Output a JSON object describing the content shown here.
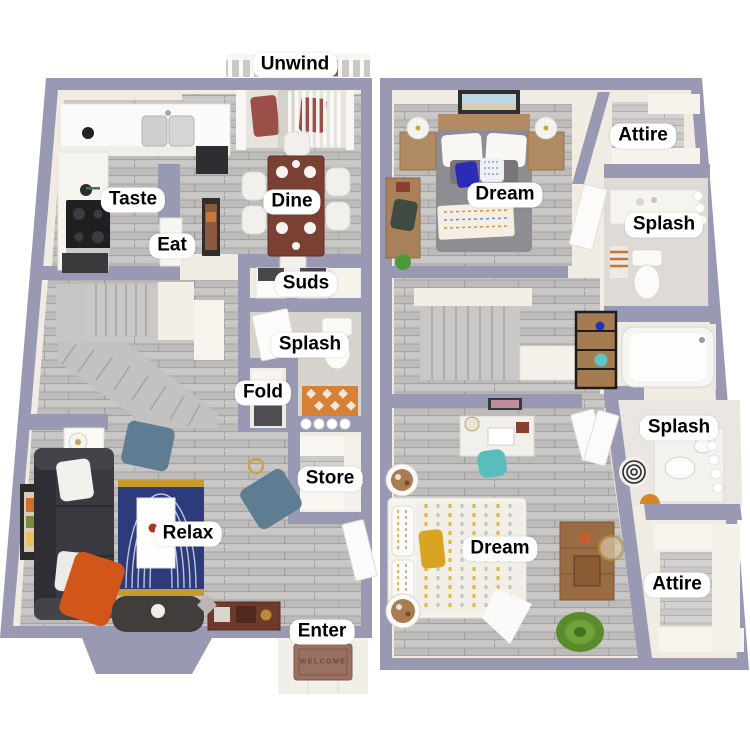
{
  "image": {
    "description": "3D rendered two-storey apartment floor plan on white background",
    "floor_count": 2
  },
  "palette": {
    "wall": "#9a99b3",
    "interior_cream": "#f0ece3",
    "floor_wood": "#bdbcba",
    "tile_gray": "#d7d4d0",
    "white_fixture": "#f7f5f0",
    "rug_navy": "#2e3b7a",
    "rug_gold": "#c79a2a",
    "accent_orange": "#d2561a",
    "tile_orange": "#d68136",
    "sofa_charcoal": "#3a393f",
    "dining_wood": "#7b4034",
    "chair_slate": "#5f7d92",
    "bed_gray": "#8e8e92",
    "teal": "#5bbcbe",
    "mustard": "#d9a422",
    "balcony_chair_maroon": "#9c4f48"
  },
  "floor1": {
    "name": "first floor",
    "labels": {
      "unwind": "Unwind",
      "taste": "Taste",
      "eat": "Eat",
      "dine": "Dine",
      "suds": "Suds",
      "splash": "Splash",
      "fold": "Fold",
      "store": "Store",
      "relax": "Relax",
      "enter": "Enter"
    },
    "welcome_mat": "WELCOME"
  },
  "floor2": {
    "name": "second floor",
    "labels": {
      "dream_front": "Dream",
      "attire_front": "Attire",
      "splash_front": "Splash",
      "splash_back": "Splash",
      "dream_back": "Dream",
      "attire_back": "Attire"
    }
  }
}
